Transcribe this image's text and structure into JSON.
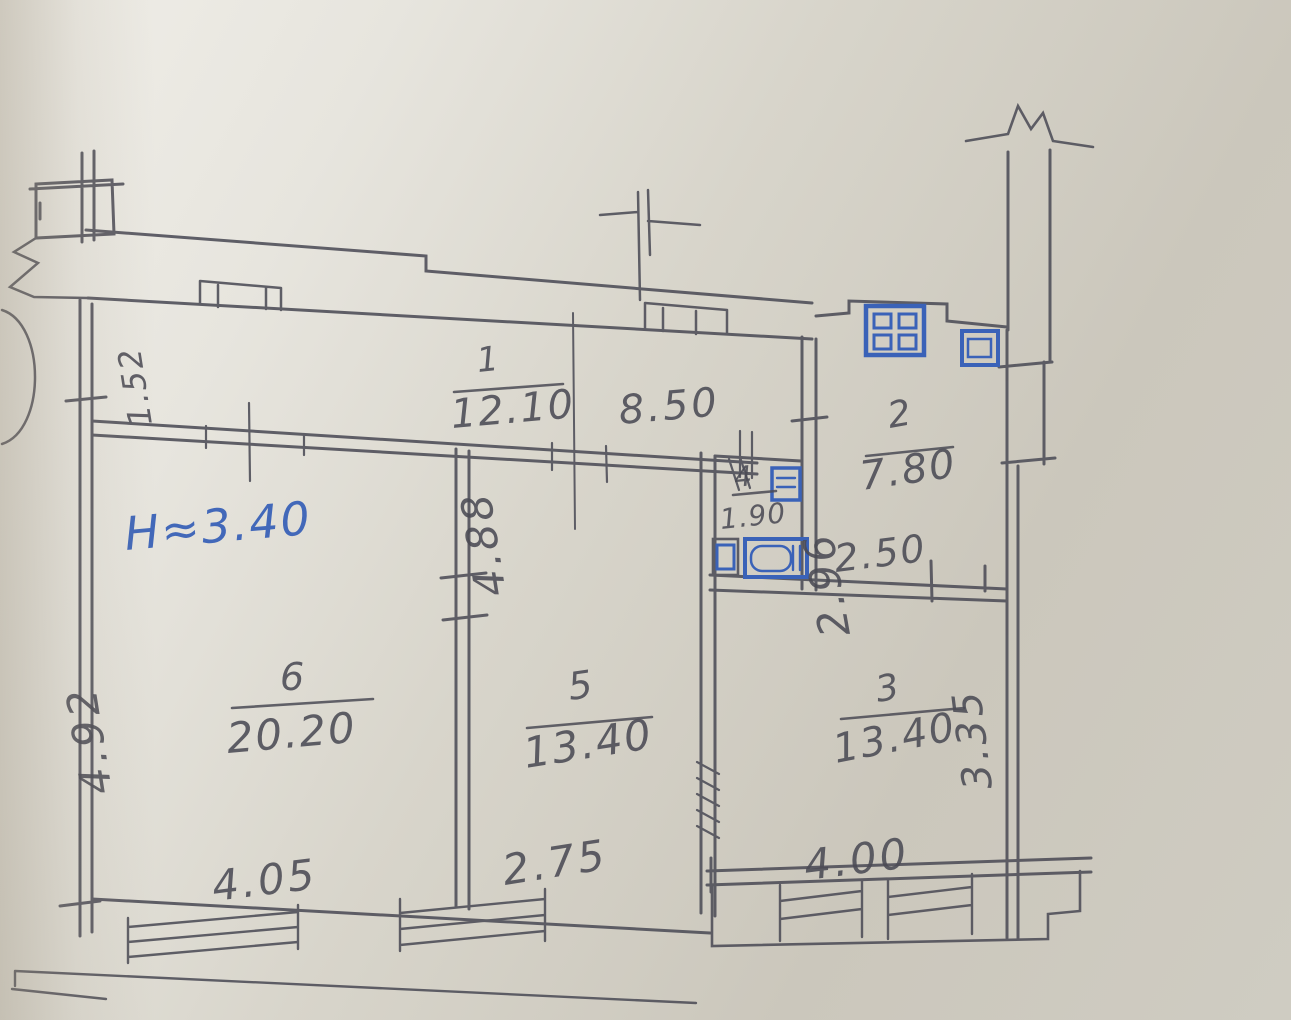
{
  "plan": {
    "height_note": "H≈3.40",
    "entry_width": "1.52",
    "rooms": {
      "hall": {
        "number": "1",
        "area": "12.10",
        "width": "8.50"
      },
      "kitchen": {
        "number": "2",
        "area": "7.80",
        "width": "2.50",
        "depth": "2.96"
      },
      "room3": {
        "number": "3",
        "area": "13.40",
        "width": "4.00",
        "depth": "3.35"
      },
      "bath": {
        "number": "4",
        "area": "1.90"
      },
      "room5": {
        "number": "5",
        "area": "13.40",
        "width": "2.75",
        "wall": "4.88"
      },
      "room6": {
        "number": "6",
        "area": "20.20",
        "width": "4.05",
        "depth": "4.92"
      }
    },
    "fixtures": {
      "stove": "stove-icon",
      "kitchen_sink": "sink-icon",
      "washbasin": "washbasin-icon",
      "bathtub": "bathtub-icon",
      "toilet": "toilet-icon"
    },
    "colors": {
      "paper": "#d3d0c6",
      "pencil": "#4b4b55",
      "ink": "#3a62b8"
    }
  }
}
